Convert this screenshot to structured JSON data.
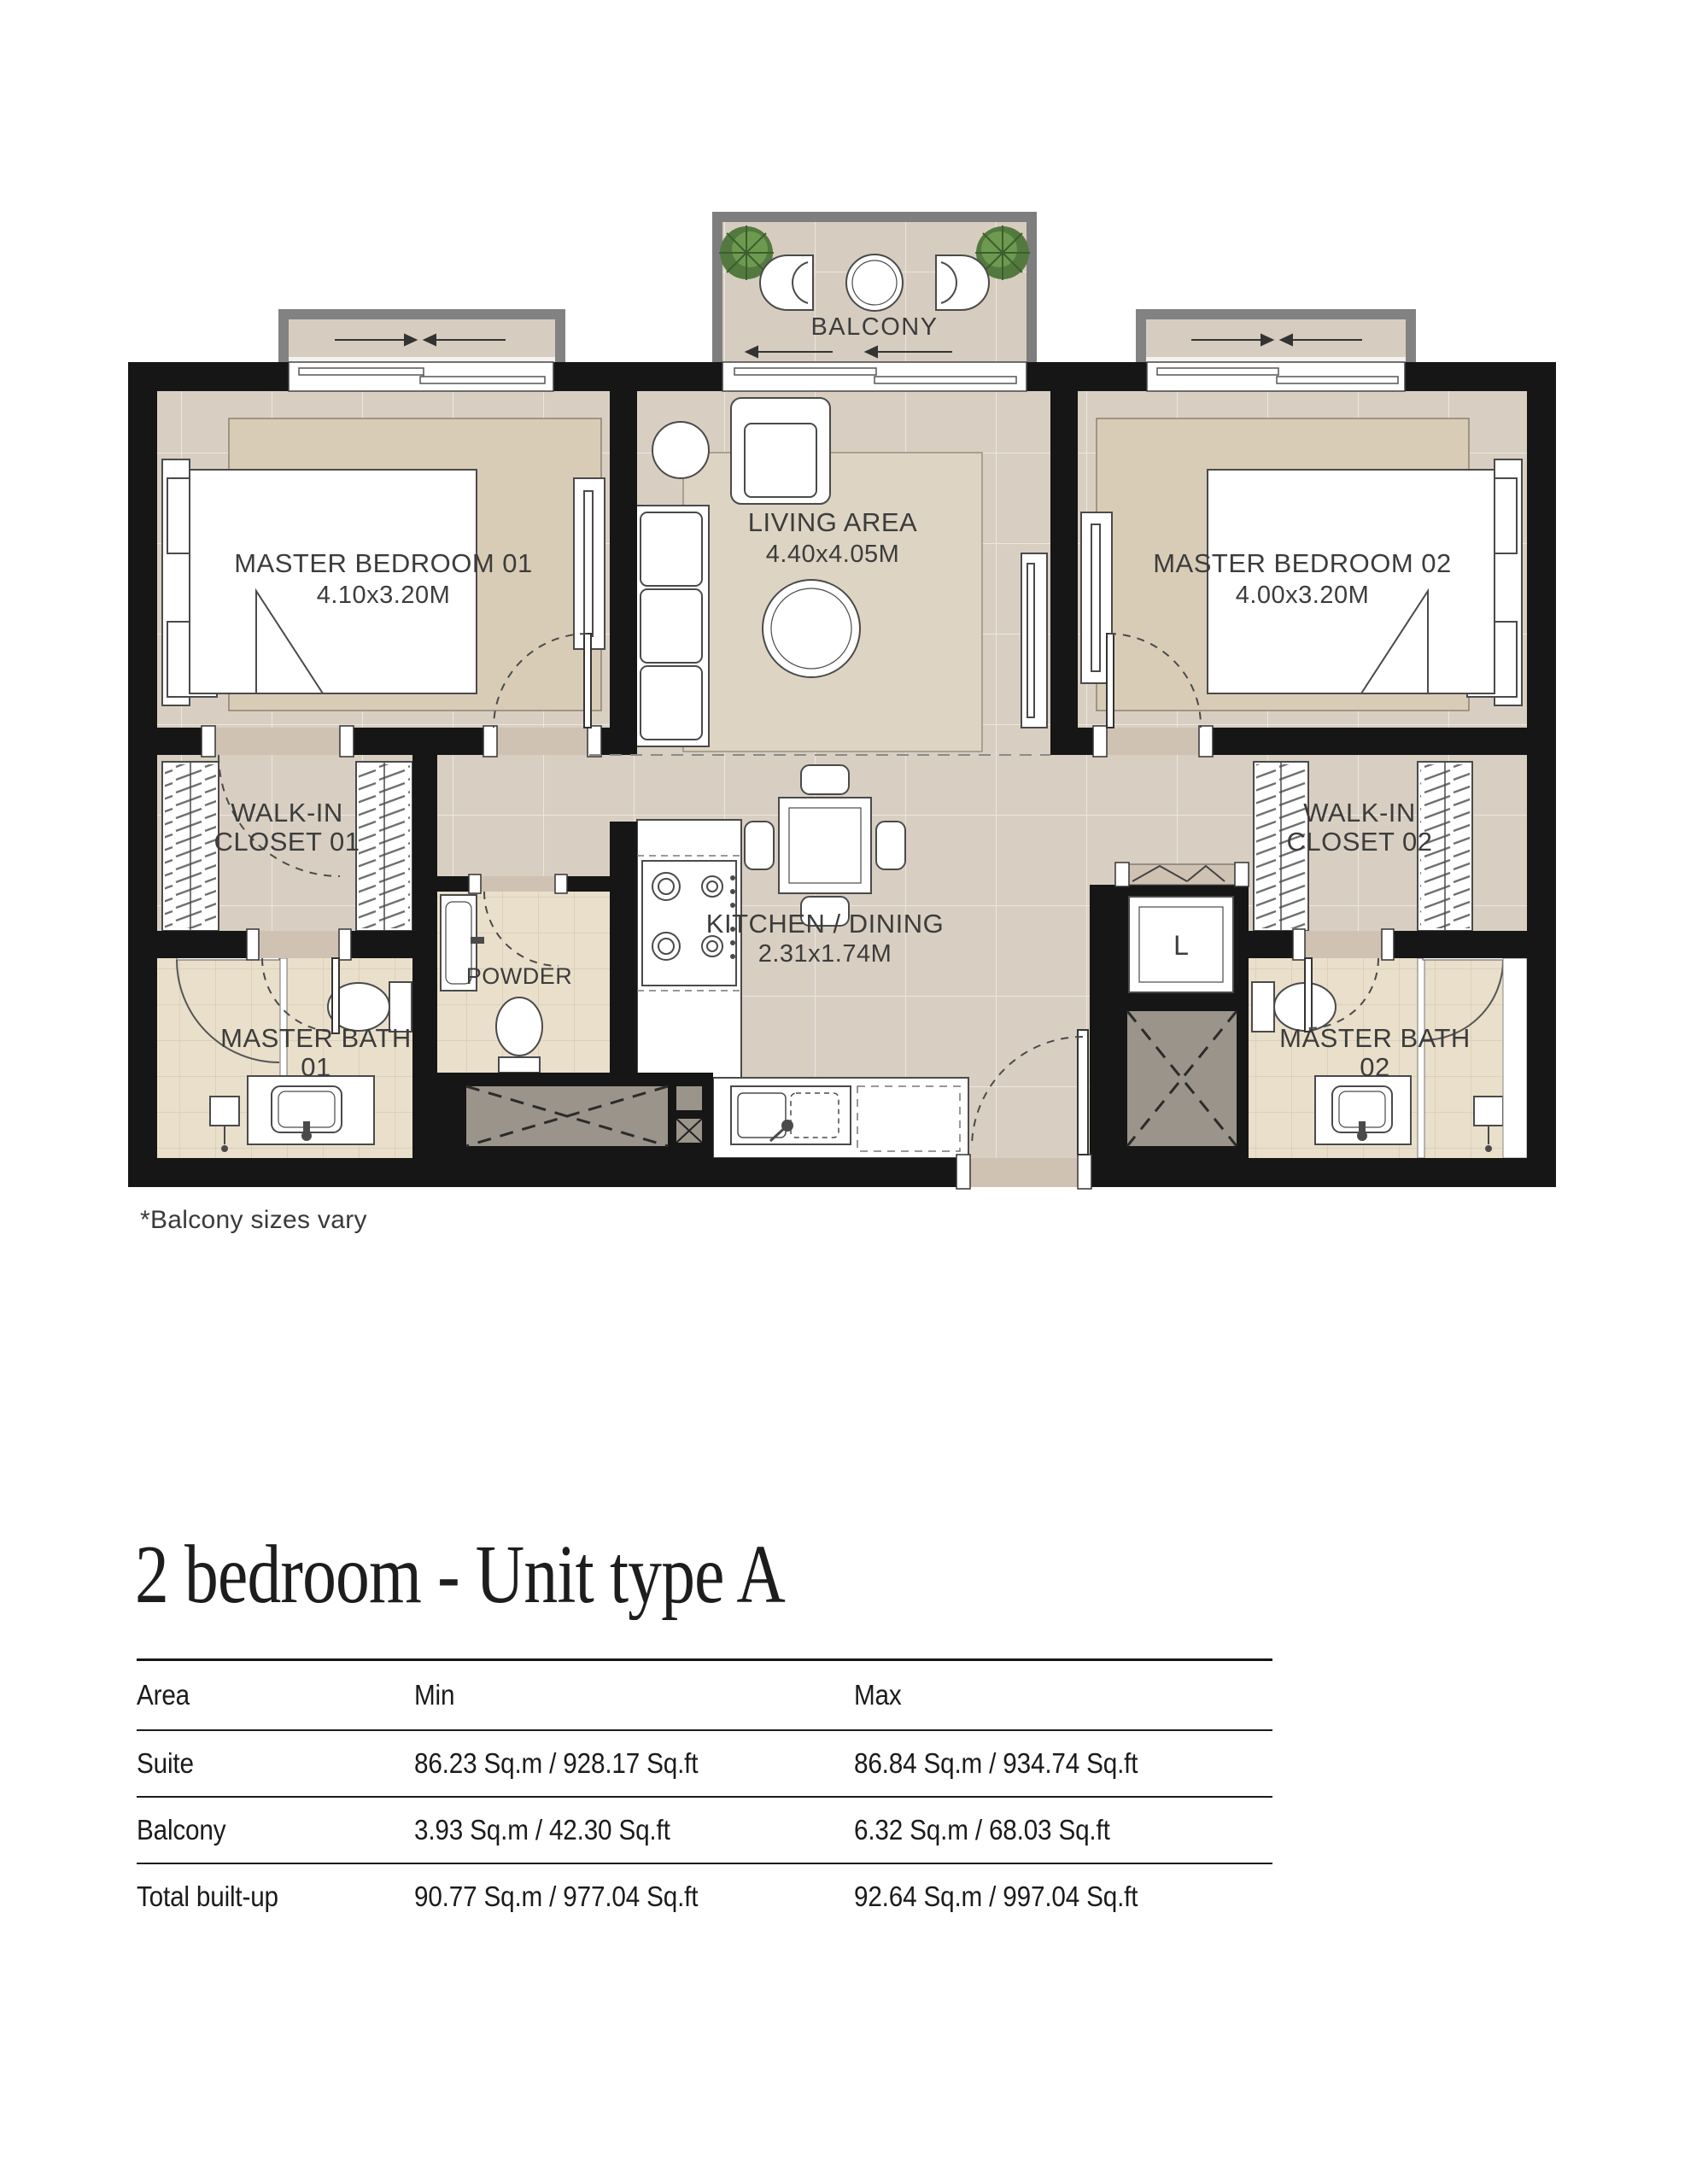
{
  "plan": {
    "balcony": {
      "label": "BALCONY"
    },
    "note": "*Balcony sizes vary",
    "rooms": {
      "bedroom1": {
        "name": "MASTER BEDROOM 01",
        "dims": "4.10x3.20M"
      },
      "living": {
        "name": "LIVING AREA",
        "dims": "4.40x4.05M"
      },
      "bedroom2": {
        "name": "MASTER BEDROOM 02",
        "dims": "4.00x3.20M"
      },
      "closet1": {
        "line1": "WALK-IN",
        "line2": "CLOSET 01"
      },
      "closet2": {
        "line1": "WALK-IN",
        "line2": "CLOSET 02"
      },
      "powder": {
        "name": "POWDER"
      },
      "bath1": {
        "line1": "MASTER BATH",
        "line2": "01"
      },
      "bath2": {
        "line1": "MASTER BATH",
        "line2": "02"
      },
      "kitchen": {
        "name": "KITCHEN / DINING",
        "dims": "2.31x1.74M"
      },
      "laundry": {
        "label": "L"
      }
    },
    "colors": {
      "wall": "#161616",
      "floor": "#d8cfc2",
      "tile": "#e9dfcb",
      "rug": "#d9ccb7",
      "frame_gray": "#828282",
      "shaft_gray": "#9a948a",
      "plant_green": "#54793f"
    }
  },
  "title": "2 bedroom - Unit type A",
  "table": {
    "headers": [
      "Area",
      "Min",
      "Max"
    ],
    "rows": [
      {
        "area": "Suite",
        "min": "86.23 Sq.m / 928.17 Sq.ft",
        "max": "86.84 Sq.m / 934.74 Sq.ft"
      },
      {
        "area": "Balcony",
        "min": "3.93 Sq.m / 42.30 Sq.ft",
        "max": "6.32 Sq.m / 68.03 Sq.ft"
      },
      {
        "area": "Total built-up",
        "min": "90.77 Sq.m / 977.04 Sq.ft",
        "max": "92.64 Sq.m / 997.04 Sq.ft"
      }
    ]
  }
}
